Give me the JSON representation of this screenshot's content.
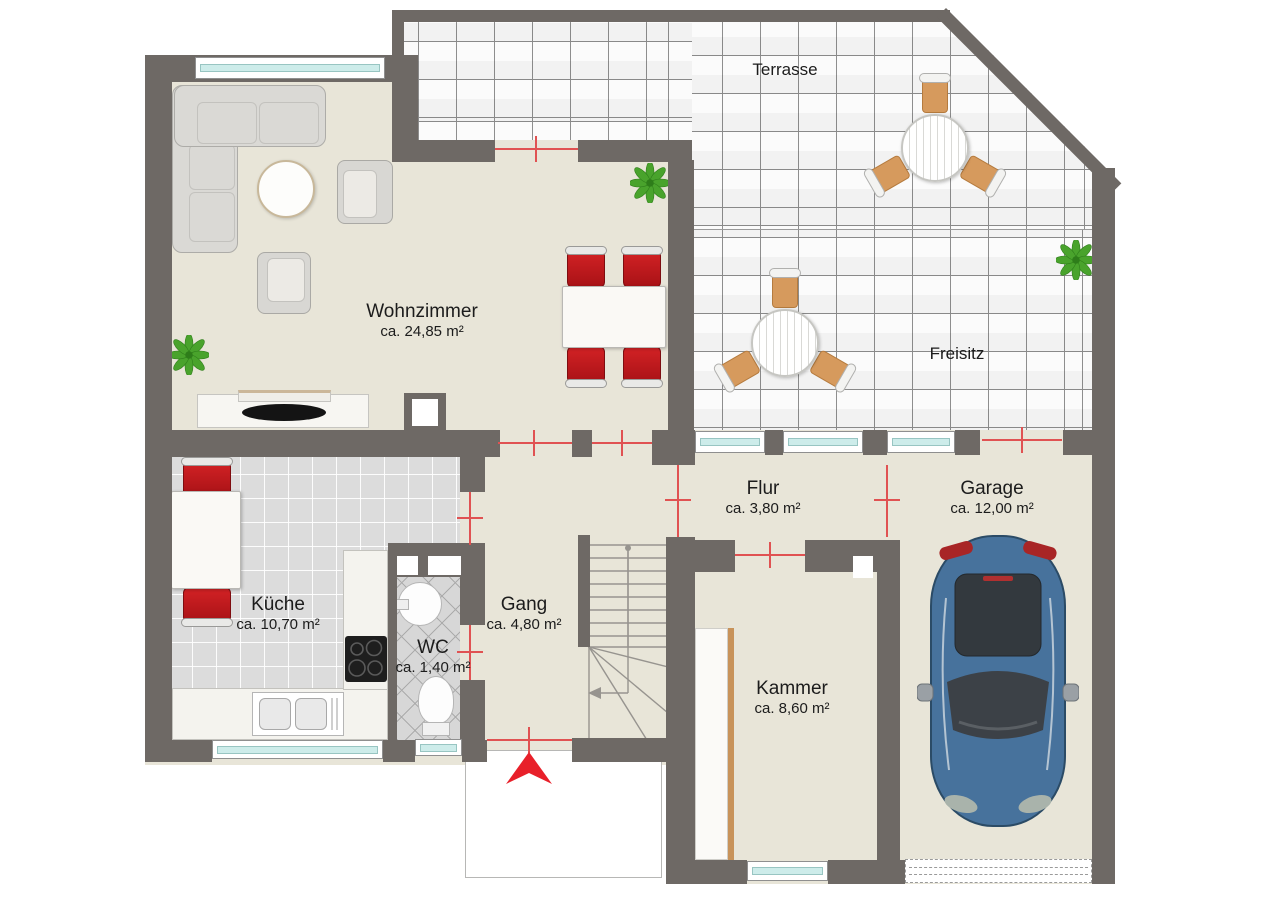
{
  "plan": {
    "rooms": [
      {
        "name": "Wohnzimmer",
        "area": "ca. 24,85 m²"
      },
      {
        "name": "Küche",
        "area": "ca. 10,70 m²"
      },
      {
        "name": "WC",
        "area": "ca. 1,40 m²"
      },
      {
        "name": "Gang",
        "area": "ca. 4,80 m²"
      },
      {
        "name": "Flur",
        "area": "ca. 3,80 m²"
      },
      {
        "name": "Kammer",
        "area": "ca. 8,60 m²"
      },
      {
        "name": "Garage",
        "area": "ca. 12,00 m²"
      },
      {
        "name": "Terrasse",
        "area": ""
      },
      {
        "name": "Freisitz",
        "area": ""
      }
    ],
    "colors": {
      "wall": "#6e6965",
      "floor_beige": "#e8e5d8",
      "kitchen_tile": "#dcdcdc",
      "terrace_tile": "#fbfbfb",
      "window_glass": "#cdecea",
      "chair_red": "#c2191d",
      "measure_red": "#e05252",
      "entrance_arrow_red": "#e8202a",
      "car_blue": "#47729c",
      "wood_tan": "#d69a5d",
      "plant_green": "#49a32c"
    }
  }
}
